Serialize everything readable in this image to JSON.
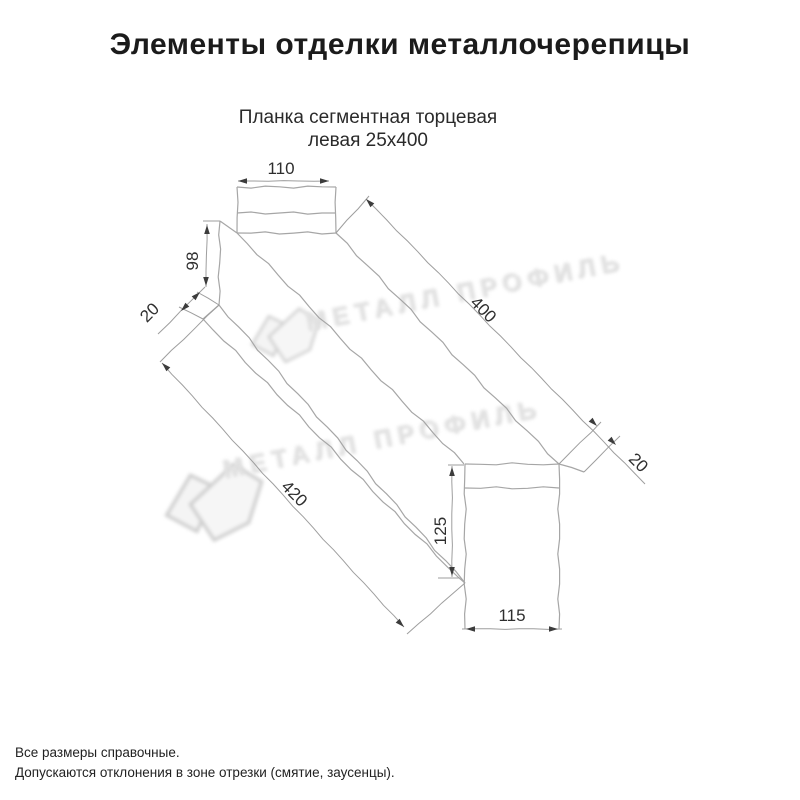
{
  "page": {
    "title": "Элементы отделки металлочерепицы",
    "subtitle_line1": "Планка сегментная торцевая",
    "subtitle_line2": "левая 25х400"
  },
  "drawing": {
    "dims": {
      "top_width": "110",
      "wall_height": "98",
      "bottom_fold": "20",
      "length_top": "400",
      "edge_fold": "20",
      "length_bottom": "420",
      "end_height": "125",
      "end_width": "115"
    }
  },
  "watermark": {
    "text": "МЕТАЛЛ ПРОФИЛЬ"
  },
  "footer": {
    "line1": "Все размеры справочные.",
    "line2": "Допускаются отклонения в зоне отрезки (смятие, заусенцы)."
  },
  "colors": {
    "body_line": "#a6a6a6",
    "dim_line": "#9e9e9e",
    "arrow": "#3c3c3c",
    "dim_text": "#2e2e2e",
    "text": "#1a1a1a",
    "watermark": "#e3e3e3"
  }
}
